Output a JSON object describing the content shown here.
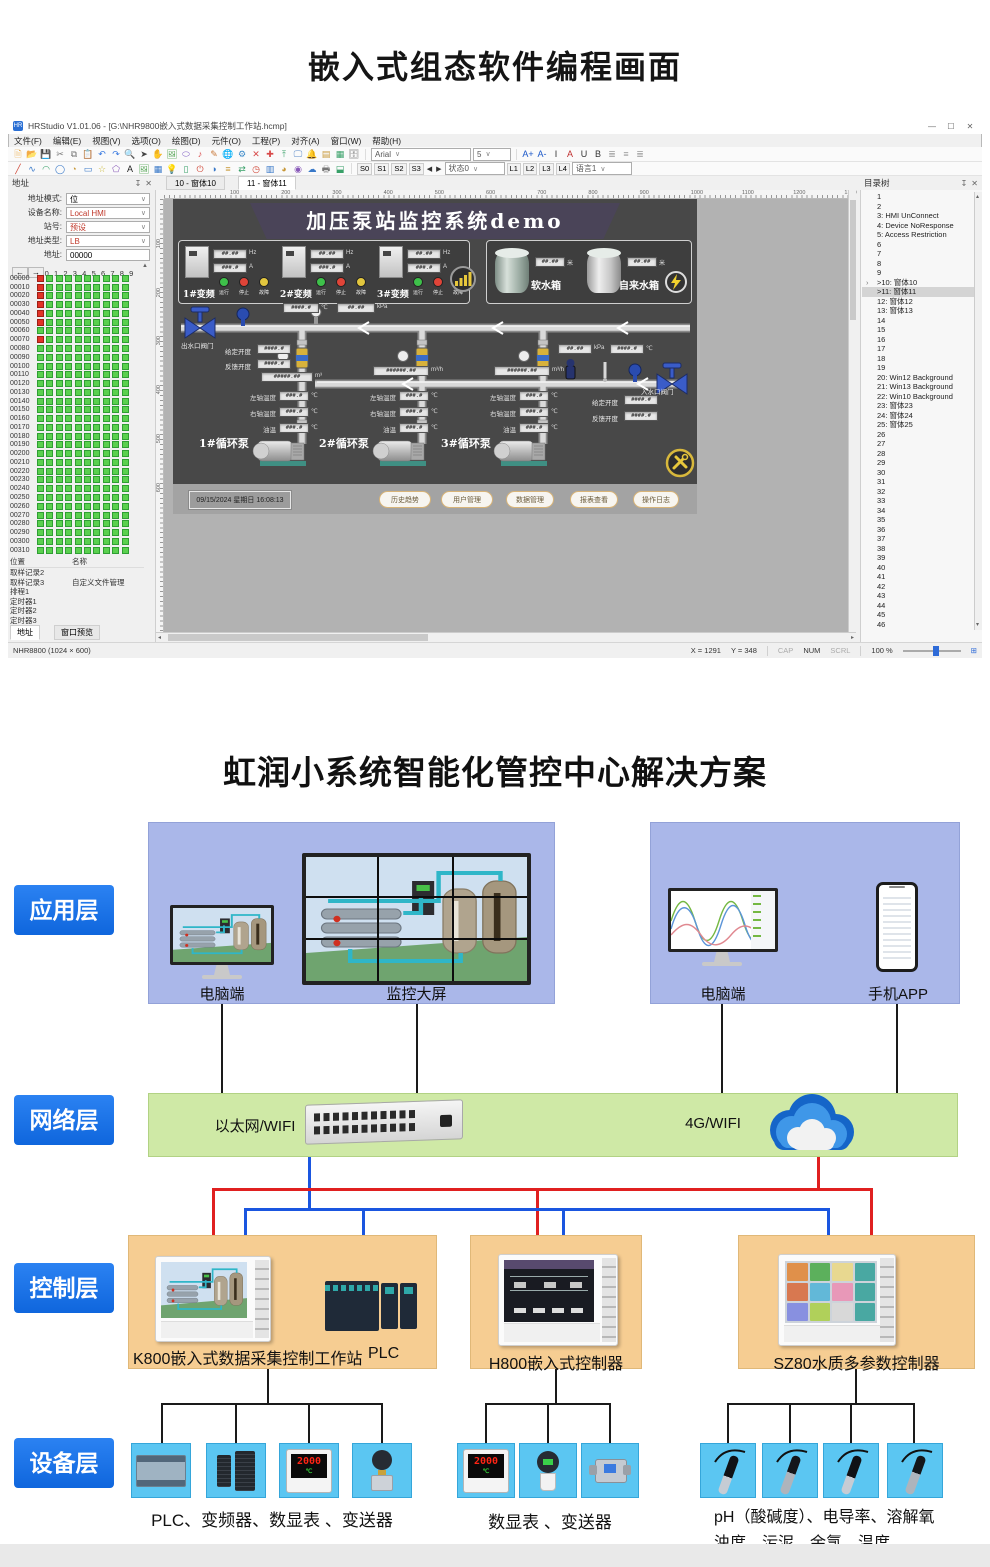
{
  "page": {
    "top_title": "嵌入式组态软件编程画面"
  },
  "window": {
    "title": "HRStudio V1.01.06 - [G:\\NHR9800嵌入式数据采集控制工作站.hcmp]",
    "menus": [
      "文件(F)",
      "编辑(E)",
      "视图(V)",
      "选项(O)",
      "绘图(D)",
      "元件(O)",
      "工程(P)",
      "对齐(A)",
      "窗口(W)",
      "帮助(H)"
    ],
    "font_name": "Arial",
    "font_size": "5",
    "states": [
      "S0",
      "S1",
      "S2",
      "S3"
    ],
    "state_select": "状态0",
    "langs": [
      "L1",
      "L2",
      "L3",
      "L4"
    ],
    "lang_select": "语言1",
    "tabs": [
      "10 - 窗体10",
      "11 - 窗体11"
    ],
    "ruler_top": [
      "100",
      "200",
      "300",
      "400",
      "500",
      "600",
      "700",
      "800",
      "900",
      "1000",
      "1100",
      "1200",
      "1300"
    ],
    "ruler_left": [
      "100",
      "200",
      "300",
      "400",
      "500",
      "600"
    ],
    "status": {
      "device": "NHR8800 (1024 × 600)",
      "x": "X = 1291",
      "y": "Y = 348",
      "cap": "CAP",
      "num": "NUM",
      "scrl": "SCRL",
      "zoom": "100 %"
    }
  },
  "address_panel": {
    "title": "地址",
    "mode_label": "地址模式:",
    "mode_value": "位",
    "device_label": "设备名称:",
    "device_value": "Local HMI",
    "station_label": "站号:",
    "station_value": "预设",
    "type_label": "地址类型:",
    "type_value": "LB",
    "addr_label": "地址:",
    "addr_value": "00000",
    "col_headers": [
      "0",
      "1",
      "2",
      "3",
      "4",
      "5",
      "6",
      "7",
      "8",
      "9"
    ],
    "grid_rows": 32,
    "grid_start": 0,
    "grid_step": 10,
    "red_rows": [
      0,
      1,
      2,
      3,
      4,
      5,
      7
    ],
    "table_headers": [
      "位置",
      "名称"
    ],
    "table_rows": [
      [
        "取样记录2",
        ""
      ],
      [
        "取样记录3",
        "自定义文件管理"
      ],
      [
        "排程1",
        ""
      ],
      [
        "定时器1",
        ""
      ],
      [
        "定时器2",
        ""
      ],
      [
        "定时器3",
        ""
      ]
    ],
    "tabs": [
      "地址",
      "窗口预览"
    ]
  },
  "tree_panel": {
    "title": "目录树",
    "selected_index": 10,
    "expander_index": 9,
    "items": [
      "1",
      "2",
      "3:  HMI UnConnect",
      "4:  Device NoResponse",
      "5:  Access Restriction",
      "6",
      "7",
      "8",
      "9",
      ">10:  窗体10",
      ">11:  窗体11",
      "12:  窗体12",
      "13:  窗体13",
      "14",
      "15",
      "16",
      "17",
      "18",
      "19",
      "20:  Win12 Background",
      "21:  Win13 Background",
      "22:  Win10 Background",
      "23:  窗体23",
      "24:  窗体24",
      "25:  窗体25",
      "26",
      "27",
      "28",
      "29",
      "30",
      "31",
      "32",
      "33",
      "34",
      "35",
      "36",
      "37",
      "38",
      "39",
      "40",
      "41",
      "42",
      "43",
      "44",
      "45",
      "46"
    ]
  },
  "hmi": {
    "banner": "加压泵站监控系统demo",
    "inverters": [
      "1#变频",
      "2#变频",
      "3#变频"
    ],
    "freq_value": "##.##",
    "freq_unit": "Hz",
    "curr_value": "###.#",
    "curr_unit": "A",
    "lamp_labels": [
      "运行",
      "停止",
      "故障"
    ],
    "tank1": "软水箱",
    "tank2": "自来水箱",
    "level_value": "##.##",
    "level_unit": "米",
    "out_valve": "出水口阀门",
    "in_valve": "入水口阀门",
    "opening_set": "给定开度",
    "opening_fb": "反馈开度",
    "opening_value": "####.#",
    "temp_value": "####.#",
    "temp_unit": "℃",
    "press_value": "##.##",
    "press_unit": "kPa",
    "total_value": "#####.##",
    "total_unit": "m³",
    "flow_value": "######.##",
    "flow_unit": "m³/h",
    "pump_rows": [
      {
        "label": "左轴温度",
        "value": "###.#",
        "unit": "℃"
      },
      {
        "label": "右轴温度",
        "value": "###.#",
        "unit": "℃"
      },
      {
        "label": "油温",
        "value": "###.#",
        "unit": "℃"
      }
    ],
    "pumps": [
      "1#循环泵",
      "2#循环泵",
      "3#循环泵"
    ],
    "datetime": "09/15/2024  星期日  16:08:13",
    "buttons": [
      "历史趋势",
      "用户管理",
      "数据管理",
      "报表查看",
      "操作日志"
    ]
  },
  "solution": {
    "title": "虹润小系统智能化管控中心解决方案",
    "layers": [
      "应用层",
      "网络层",
      "控制层",
      "设备层"
    ],
    "pc_label_1": "电脑端",
    "wall_label": "监控大屏",
    "pc_label_2": "电脑端",
    "phone_label": "手机APP",
    "ethernet_label": "以太网/WIFI",
    "cloud_label": "4G/WIFI",
    "k800_label": "K800嵌入式数据采集控制工作站",
    "plc_label": "PLC",
    "h800_label": "H800嵌入式控制器",
    "sz80_label": "SZ80水质多参数控制器",
    "group1_caption": "PLC、变频器、数显表 、变送器",
    "group2_caption": "数显表 、变送器",
    "group3_caption_line1": "pH（酸碱度）、电导率、溶解氧",
    "group3_caption_line2": "浊度、污泥、余氯、温度",
    "meter_reading": "2000",
    "meter_unit": "℃"
  },
  "icons": {
    "r1": [
      [
        "new-file-icon",
        "🗎",
        "#e8a53c"
      ],
      [
        "open-folder-icon",
        "📂",
        "#e0b050"
      ],
      [
        "save-icon",
        "💾",
        "#4a78c8"
      ],
      [
        "cut-icon",
        "✂",
        "#777777"
      ],
      [
        "copy-icon",
        "⧉",
        "#777777"
      ],
      [
        "paste-icon",
        "📋",
        "#b8863c"
      ],
      [
        "undo-icon",
        "↶",
        "#3a7ae0"
      ],
      [
        "redo-icon",
        "↷",
        "#3a7ae0"
      ],
      [
        "find-icon",
        "🔍",
        "#555555"
      ],
      [
        "cursor-icon",
        "➤",
        "#444444"
      ],
      [
        "hand-icon",
        "✋",
        "#d8a050"
      ],
      [
        "image-icon",
        "🖼",
        "#58a858"
      ],
      [
        "ellipse-icon",
        "⬭",
        "#8868c8"
      ],
      [
        "music-icon",
        "♪",
        "#d84848"
      ],
      [
        "pencil-icon",
        "✎",
        "#c87838"
      ],
      [
        "globe-icon",
        "🌐",
        "#3888c8"
      ],
      [
        "gear-icon",
        "⚙",
        "#3888c8"
      ],
      [
        "close-tool-icon",
        "✕",
        "#d84848"
      ],
      [
        "plus-icon",
        "✚",
        "#d84848"
      ],
      [
        "upload-icon",
        "⤒",
        "#38a068"
      ],
      [
        "monitor-icon",
        "🖵",
        "#5888c8"
      ],
      [
        "bell-icon",
        "🔔",
        "#d84848"
      ],
      [
        "report-icon",
        "▤",
        "#c89838"
      ],
      [
        "table-icon",
        "▦",
        "#38a068"
      ],
      [
        "database-icon",
        "🗄",
        "#888888"
      ]
    ],
    "r2": [
      [
        "line-icon",
        "╱",
        "#d04838"
      ],
      [
        "curve-icon",
        "∿",
        "#3878c8"
      ],
      [
        "arc-icon",
        "◠",
        "#38a068"
      ],
      [
        "circle-icon",
        "◯",
        "#3878c8"
      ],
      [
        "pie-icon",
        "◔",
        "#c89838"
      ],
      [
        "rect-icon",
        "▭",
        "#3878c8"
      ],
      [
        "star-icon",
        "☆",
        "#c8b838"
      ],
      [
        "polygon-icon",
        "⬠",
        "#8858b8"
      ],
      [
        "text-icon",
        "A",
        "#222222"
      ],
      [
        "picture-icon",
        "🖼",
        "#58a858"
      ],
      [
        "grid-icon",
        "▦",
        "#3878c8"
      ],
      [
        "bulb-icon",
        "💡",
        "#c8a838"
      ],
      [
        "battery-icon",
        "▯",
        "#38a068"
      ],
      [
        "switch-icon",
        "⏻",
        "#d04838"
      ],
      [
        "meter-icon",
        "◑",
        "#3878c8"
      ],
      [
        "list-icon",
        "≡",
        "#c89838"
      ],
      [
        "link-icon",
        "⇄",
        "#38a068"
      ],
      [
        "clock-icon",
        "◷",
        "#d04838"
      ],
      [
        "bar-chart-icon",
        "▥",
        "#3878c8"
      ],
      [
        "pie-chart-icon",
        "◕",
        "#c89838"
      ],
      [
        "gauge-icon",
        "◉",
        "#8858b8"
      ],
      [
        "cloud-icon",
        "☁",
        "#3878c8"
      ],
      [
        "printer-icon",
        "🖶",
        "#777777"
      ],
      [
        "component-icon",
        "⬓",
        "#38a068"
      ]
    ],
    "fmt": [
      [
        "font-increase-button",
        "A+",
        "#1a57c8"
      ],
      [
        "font-decrease-button",
        "A-",
        "#1a57c8"
      ],
      [
        "italic-button",
        "I",
        "#333333"
      ],
      [
        "font-color-button",
        "A",
        "#c03030"
      ],
      [
        "underline-button",
        "U",
        "#333333"
      ],
      [
        "bold-button",
        "B",
        "#333333"
      ],
      [
        "align-left-icon",
        "≣",
        "#999999"
      ],
      [
        "align-center-icon",
        "≡",
        "#999999"
      ],
      [
        "align-right-icon",
        "≣",
        "#999999"
      ]
    ]
  }
}
